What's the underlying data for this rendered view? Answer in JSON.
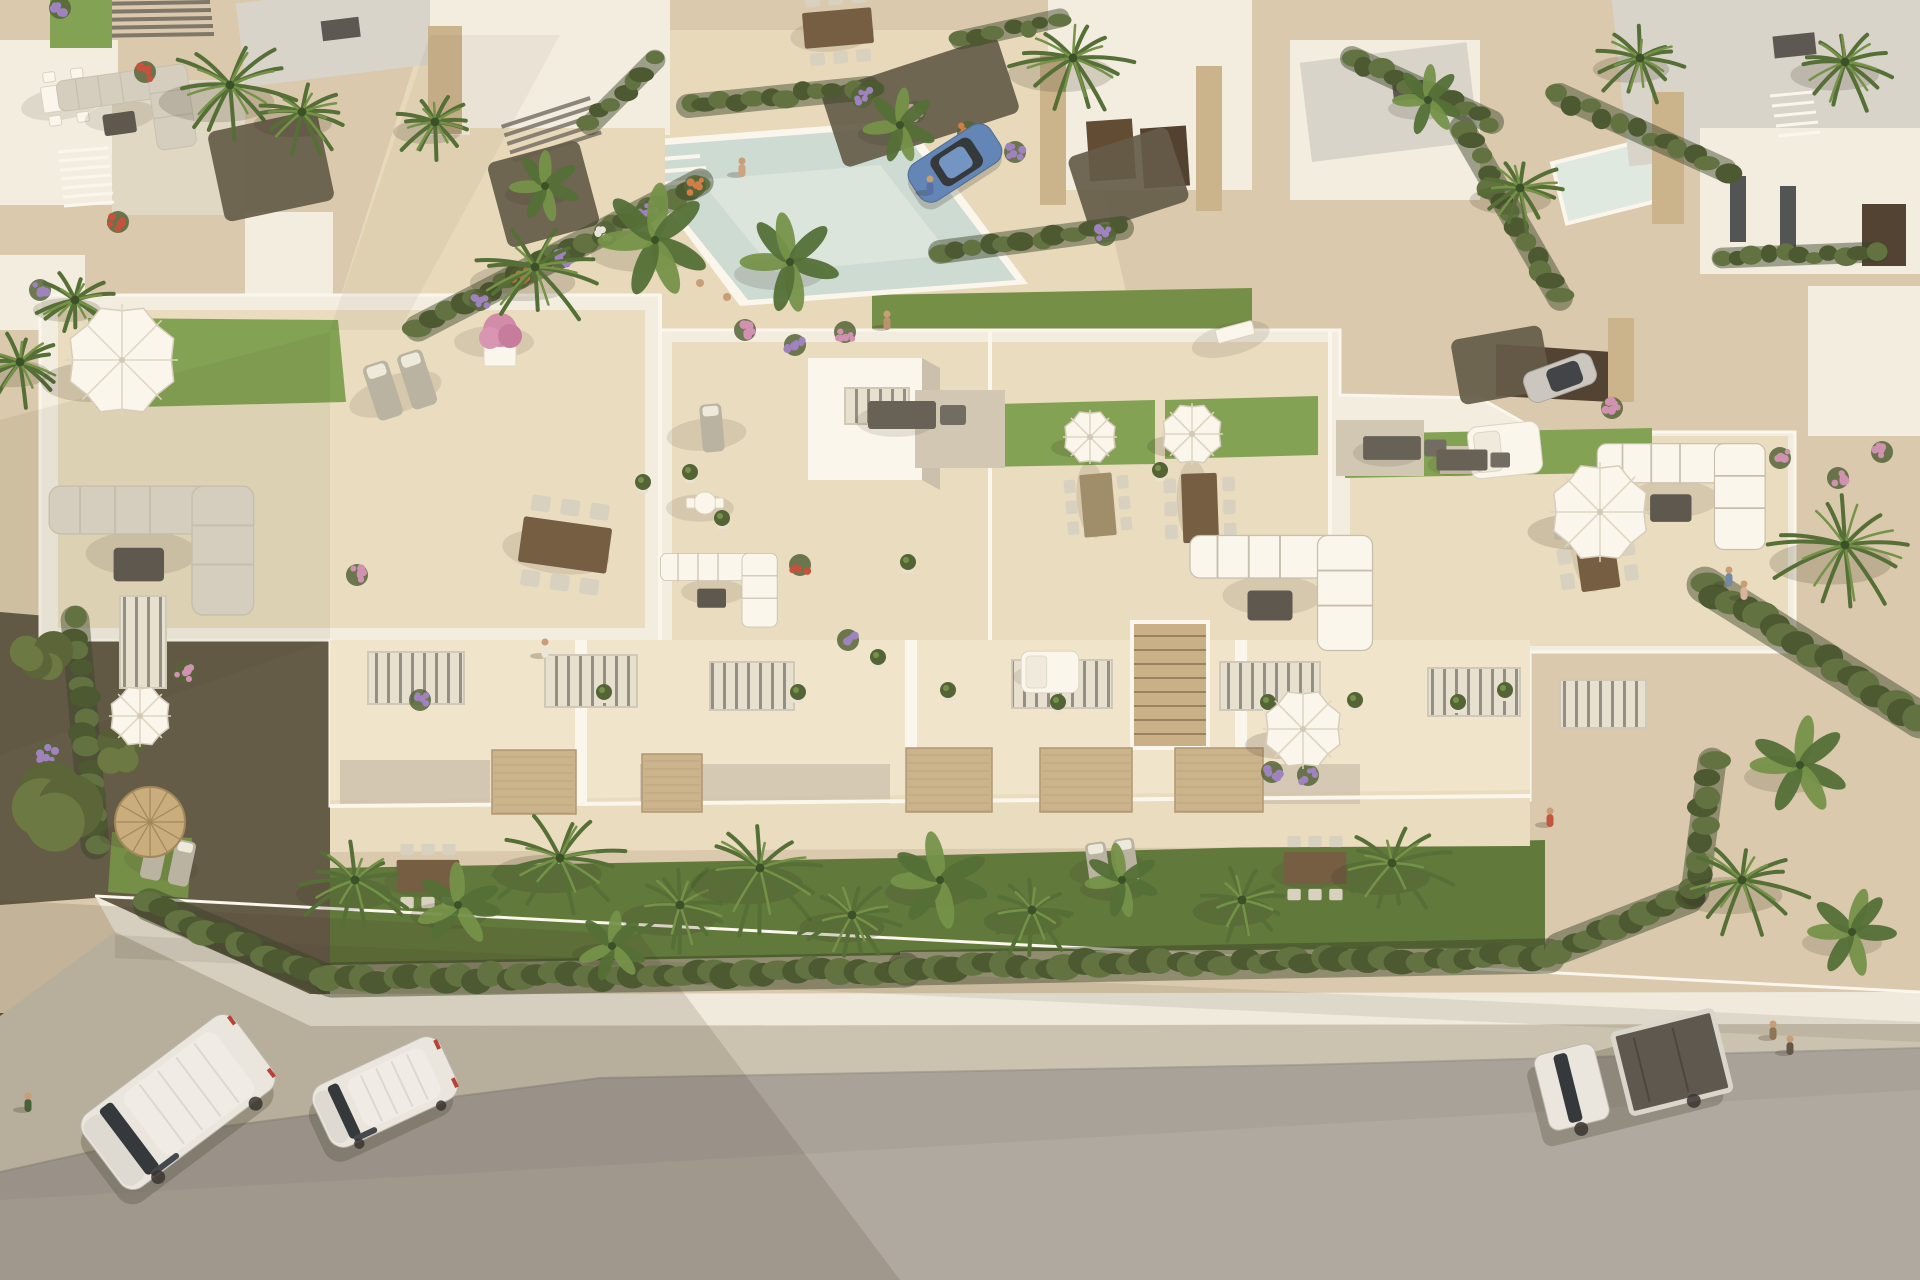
{
  "image": {
    "description": "Aerial 3D render of a white Mediterranean apartment complex with rooftop lawn terraces, parasols, balconies, front gardens with palms and hedges, a community pool plaza behind, neighbouring villas, and a grey street in front with two white vans and a white flatbed truck parked."
  },
  "palette": {
    "sand": "#d8c9ad",
    "sandLight": "#e7dabd",
    "deck": "#e9ddc1",
    "deckBright": "#f0e6cd",
    "white": "#f3efe4",
    "whiteBright": "#fbf8f1",
    "whiteShade": "#e0d8c7",
    "shade": "#c9bfac",
    "roofGray": "#d7d4cc",
    "roofDark": "#55534e",
    "charcoal": "#625d55",
    "stone": "#c9b28c",
    "stoneDark": "#ab9470",
    "wood": "#c8ae85",
    "woodDark": "#6e583e",
    "lawn": "#6f8c42",
    "lawnDark": "#5a7437",
    "lawnRoof": "#7da050",
    "hedge": "#43532c",
    "hedgeLight": "#5a6d3c",
    "palm": "#4c6a31",
    "palmLight": "#6f8f44",
    "palmDark": "#324a22",
    "gravel": "#5d5644",
    "gravelLight": "#cfc7b4",
    "pool": "#ccdcd6",
    "poolLight": "#dfeae4",
    "road": "#a5a099",
    "roadLight": "#b2ada5",
    "sidewalk": "#c9c2b1",
    "wall": "#efebdf",
    "gate": "#5e4a35",
    "glass": "#2c3137",
    "van": "#e9e7e2",
    "vanShade": "#cfccc6",
    "blueCar": "#5b82b8",
    "silverCar": "#c9c7c1",
    "bedDark": "#56524b",
    "skin": "#c59b74",
    "boulder": "#c2a176",
    "straw": "#c7ab7b",
    "strawDark": "#9c8458",
    "purple": "#9a7fc0",
    "pink": "#cf8fb4",
    "red": "#c14b38",
    "orange": "#cf7a41",
    "flowerWhite": "#e8e6df",
    "potGreen": "#4c5e32",
    "pinkTree": "#cf8aa8"
  },
  "scene": {
    "palms": [
      [
        230,
        85,
        68
      ],
      [
        302,
        112,
        46
      ],
      [
        535,
        267,
        62
      ],
      [
        435,
        122,
        40
      ],
      [
        1073,
        58,
        62
      ],
      [
        1520,
        188,
        48
      ],
      [
        1845,
        62,
        52
      ],
      [
        20,
        362,
        46
      ],
      [
        75,
        300,
        40
      ],
      [
        355,
        880,
        56
      ],
      [
        560,
        858,
        64
      ],
      [
        680,
        905,
        56
      ],
      [
        760,
        868,
        66
      ],
      [
        852,
        915,
        50
      ],
      [
        1032,
        910,
        46
      ],
      [
        1242,
        900,
        47
      ],
      [
        1392,
        863,
        58
      ],
      [
        1742,
        880,
        62
      ],
      [
        1845,
        545,
        72
      ],
      [
        1640,
        58,
        45
      ]
    ],
    "bananas": [
      [
        900,
        125,
        42
      ],
      [
        655,
        240,
        64
      ],
      [
        790,
        262,
        56
      ],
      [
        545,
        186,
        40
      ],
      [
        458,
        905,
        48
      ],
      [
        612,
        946,
        40
      ],
      [
        940,
        880,
        55
      ],
      [
        1122,
        880,
        42
      ],
      [
        1852,
        932,
        50
      ],
      [
        1800,
        765,
        56
      ],
      [
        1428,
        100,
        40
      ]
    ],
    "mounds": [
      [
        68,
        800,
        56
      ],
      [
        40,
        662,
        36
      ],
      [
        120,
        752,
        30
      ]
    ],
    "hedges": [
      [
        150,
        905,
        320,
        978,
        42
      ],
      [
        332,
        980,
        905,
        970,
        44
      ],
      [
        905,
        968,
        1548,
        956,
        44
      ],
      [
        1560,
        948,
        1688,
        898,
        40
      ],
      [
        1695,
        892,
        1712,
        762,
        36
      ],
      [
        75,
        620,
        95,
        845,
        36
      ],
      [
        418,
        328,
        700,
        182,
        34
      ],
      [
        688,
        106,
        868,
        88,
        30
      ],
      [
        940,
        252,
        1122,
        228,
        30
      ],
      [
        1352,
        58,
        1492,
        122,
        30
      ],
      [
        1462,
        128,
        1560,
        298,
        32
      ],
      [
        1560,
        95,
        1725,
        170,
        30
      ],
      [
        1722,
        258,
        1878,
        252,
        26
      ],
      [
        1705,
        585,
        1920,
        720,
        46
      ],
      [
        590,
        125,
        655,
        60,
        26
      ],
      [
        960,
        40,
        1060,
        18,
        24
      ]
    ],
    "flowers": [
      [
        60,
        8,
        "purple"
      ],
      [
        145,
        72,
        "red"
      ],
      [
        40,
        290,
        "purple"
      ],
      [
        47,
        753,
        "purple"
      ],
      [
        185,
        672,
        "pink"
      ],
      [
        480,
        300,
        "purple"
      ],
      [
        520,
        278,
        "orange"
      ],
      [
        560,
        258,
        "purple"
      ],
      [
        605,
        232,
        "flowerWhite"
      ],
      [
        648,
        208,
        "purple"
      ],
      [
        695,
        186,
        "orange"
      ],
      [
        862,
        97,
        "purple"
      ],
      [
        915,
        112,
        "pink"
      ],
      [
        968,
        132,
        "orange"
      ],
      [
        1015,
        152,
        "purple"
      ],
      [
        745,
        330,
        "pink"
      ],
      [
        795,
        345,
        "purple"
      ],
      [
        845,
        332,
        "pink"
      ],
      [
        1780,
        458,
        "pink"
      ],
      [
        1838,
        478,
        "pink"
      ],
      [
        1882,
        452,
        "pink"
      ],
      [
        1612,
        408,
        "pink"
      ],
      [
        420,
        700,
        "purple"
      ],
      [
        848,
        640,
        "purple"
      ],
      [
        1272,
        772,
        "purple"
      ],
      [
        1308,
        775,
        "purple"
      ],
      [
        357,
        575,
        "pink"
      ],
      [
        800,
        565,
        "red"
      ],
      [
        118,
        222,
        "red"
      ],
      [
        1105,
        235,
        "purple"
      ]
    ],
    "pots": [
      [
        690,
        472
      ],
      [
        643,
        482
      ],
      [
        798,
        692
      ],
      [
        878,
        657
      ],
      [
        1058,
        702
      ],
      [
        908,
        562
      ],
      [
        1458,
        702
      ],
      [
        604,
        692
      ],
      [
        1268,
        702
      ],
      [
        948,
        690
      ],
      [
        1160,
        470
      ],
      [
        722,
        518
      ],
      [
        1355,
        700
      ],
      [
        1505,
        690
      ]
    ],
    "parasols": [
      [
        122,
        360,
        56,
        "white"
      ],
      [
        1090,
        437,
        27,
        "white"
      ],
      [
        1192,
        434,
        31,
        "white"
      ],
      [
        1600,
        512,
        50,
        "white"
      ],
      [
        140,
        716,
        31,
        "white"
      ],
      [
        150,
        822,
        35,
        "straw"
      ],
      [
        1303,
        729,
        40,
        "white"
      ]
    ],
    "furniture": [
      [
        "sofaL",
        150,
        545,
        0,
        1.4,
        "gray"
      ],
      [
        "dining",
        565,
        545,
        8,
        1.35,
        "dark"
      ],
      [
        "loungers",
        400,
        385,
        -18,
        1.2,
        ""
      ],
      [
        "lounger1",
        712,
        428,
        -5,
        1,
        ""
      ],
      [
        "tableW",
        705,
        503,
        0,
        0.85,
        ""
      ],
      [
        "counter",
        902,
        415,
        0,
        1,
        ""
      ],
      [
        "dining",
        1098,
        505,
        85,
        0.95,
        "mid"
      ],
      [
        "dining",
        1200,
        508,
        88,
        1.05,
        "dark"
      ],
      [
        "sofaL",
        1280,
        588,
        0,
        1.25,
        "white"
      ],
      [
        "counter",
        1392,
        448,
        0,
        0.85,
        ""
      ],
      [
        "daybed",
        1505,
        450,
        -6,
        1,
        ""
      ],
      [
        "bench",
        1235,
        332,
        -15,
        1,
        ""
      ],
      [
        "dining",
        1596,
        552,
        82,
        1.15,
        "dark"
      ],
      [
        "sofaL",
        1680,
        492,
        0,
        1.15,
        "white"
      ],
      [
        "counter",
        1462,
        460,
        0,
        0.75,
        ""
      ],
      [
        "dining",
        428,
        876,
        0,
        0.95,
        "dark"
      ],
      [
        "loungers",
        1112,
        863,
        -8,
        0.95,
        ""
      ],
      [
        "dining",
        1315,
        868,
        0,
        0.95,
        "dark"
      ],
      [
        "sofaL",
        718,
        587,
        0,
        0.8,
        "white"
      ],
      [
        "loungers",
        168,
        860,
        12,
        0.95,
        ""
      ],
      [
        "diningW",
        66,
        97,
        -8,
        1,
        ""
      ],
      [
        "sofaL",
        125,
        110,
        -8,
        0.9,
        "gray"
      ],
      [
        "dining",
        838,
        28,
        -5,
        1.05,
        "dark"
      ],
      [
        "daybed",
        1050,
        672,
        0,
        0.8,
        ""
      ],
      [
        "pinkTree",
        500,
        336,
        0,
        1,
        ""
      ]
    ],
    "vehicles": [
      [
        "van",
        178,
        1102,
        -37,
        1
      ],
      [
        "van",
        385,
        1092,
        -25,
        0.74
      ],
      [
        "truck",
        1632,
        1072,
        -14,
        1
      ],
      [
        "hatch",
        955,
        163,
        -33,
        1
      ],
      [
        "sedan",
        1560,
        378,
        -20,
        1
      ]
    ],
    "people": [
      [
        742,
        168,
        "#caa27d"
      ],
      [
        887,
        321,
        "#b6906e"
      ],
      [
        930,
        186,
        "#4d6ca8"
      ],
      [
        545,
        649,
        "#eae6dc"
      ],
      [
        1729,
        577,
        "#6b86a8"
      ],
      [
        1744,
        591,
        "#d8b2a0"
      ],
      [
        1773,
        1031,
        "#8a6f52"
      ],
      [
        1790,
        1046,
        "#5d5144"
      ],
      [
        28,
        1103,
        "#3f5a36"
      ],
      [
        1550,
        818,
        "#c0503c"
      ]
    ],
    "gravels": [
      [
        828,
        62,
        185,
        80,
        -18
      ],
      [
        1076,
        140,
        105,
        78,
        -18
      ],
      [
        496,
        150,
        95,
        88,
        -15
      ],
      [
        1455,
        332,
        92,
        66,
        -10
      ],
      [
        215,
        120,
        112,
        92,
        -12
      ]
    ],
    "patios": [
      [
        915,
        390,
        90,
        78
      ],
      [
        1336,
        420,
        88,
        56
      ],
      [
        1440,
        446,
        64,
        28
      ]
    ],
    "windows": [
      [
        368,
        652,
        96,
        52
      ],
      [
        545,
        655,
        92,
        52
      ],
      [
        710,
        662,
        84,
        48
      ],
      [
        1012,
        660,
        100,
        48
      ],
      [
        1220,
        662,
        100,
        48
      ],
      [
        1428,
        668,
        92,
        48
      ],
      [
        120,
        596,
        46,
        92
      ],
      [
        845,
        388,
        64,
        36
      ],
      [
        1560,
        680,
        86,
        48
      ]
    ],
    "panels": [
      [
        492,
        750,
        84,
        64
      ],
      [
        642,
        754,
        60,
        58
      ],
      [
        906,
        748,
        86,
        64
      ],
      [
        1040,
        748,
        92,
        64
      ],
      [
        1175,
        748,
        88,
        64
      ]
    ]
  }
}
